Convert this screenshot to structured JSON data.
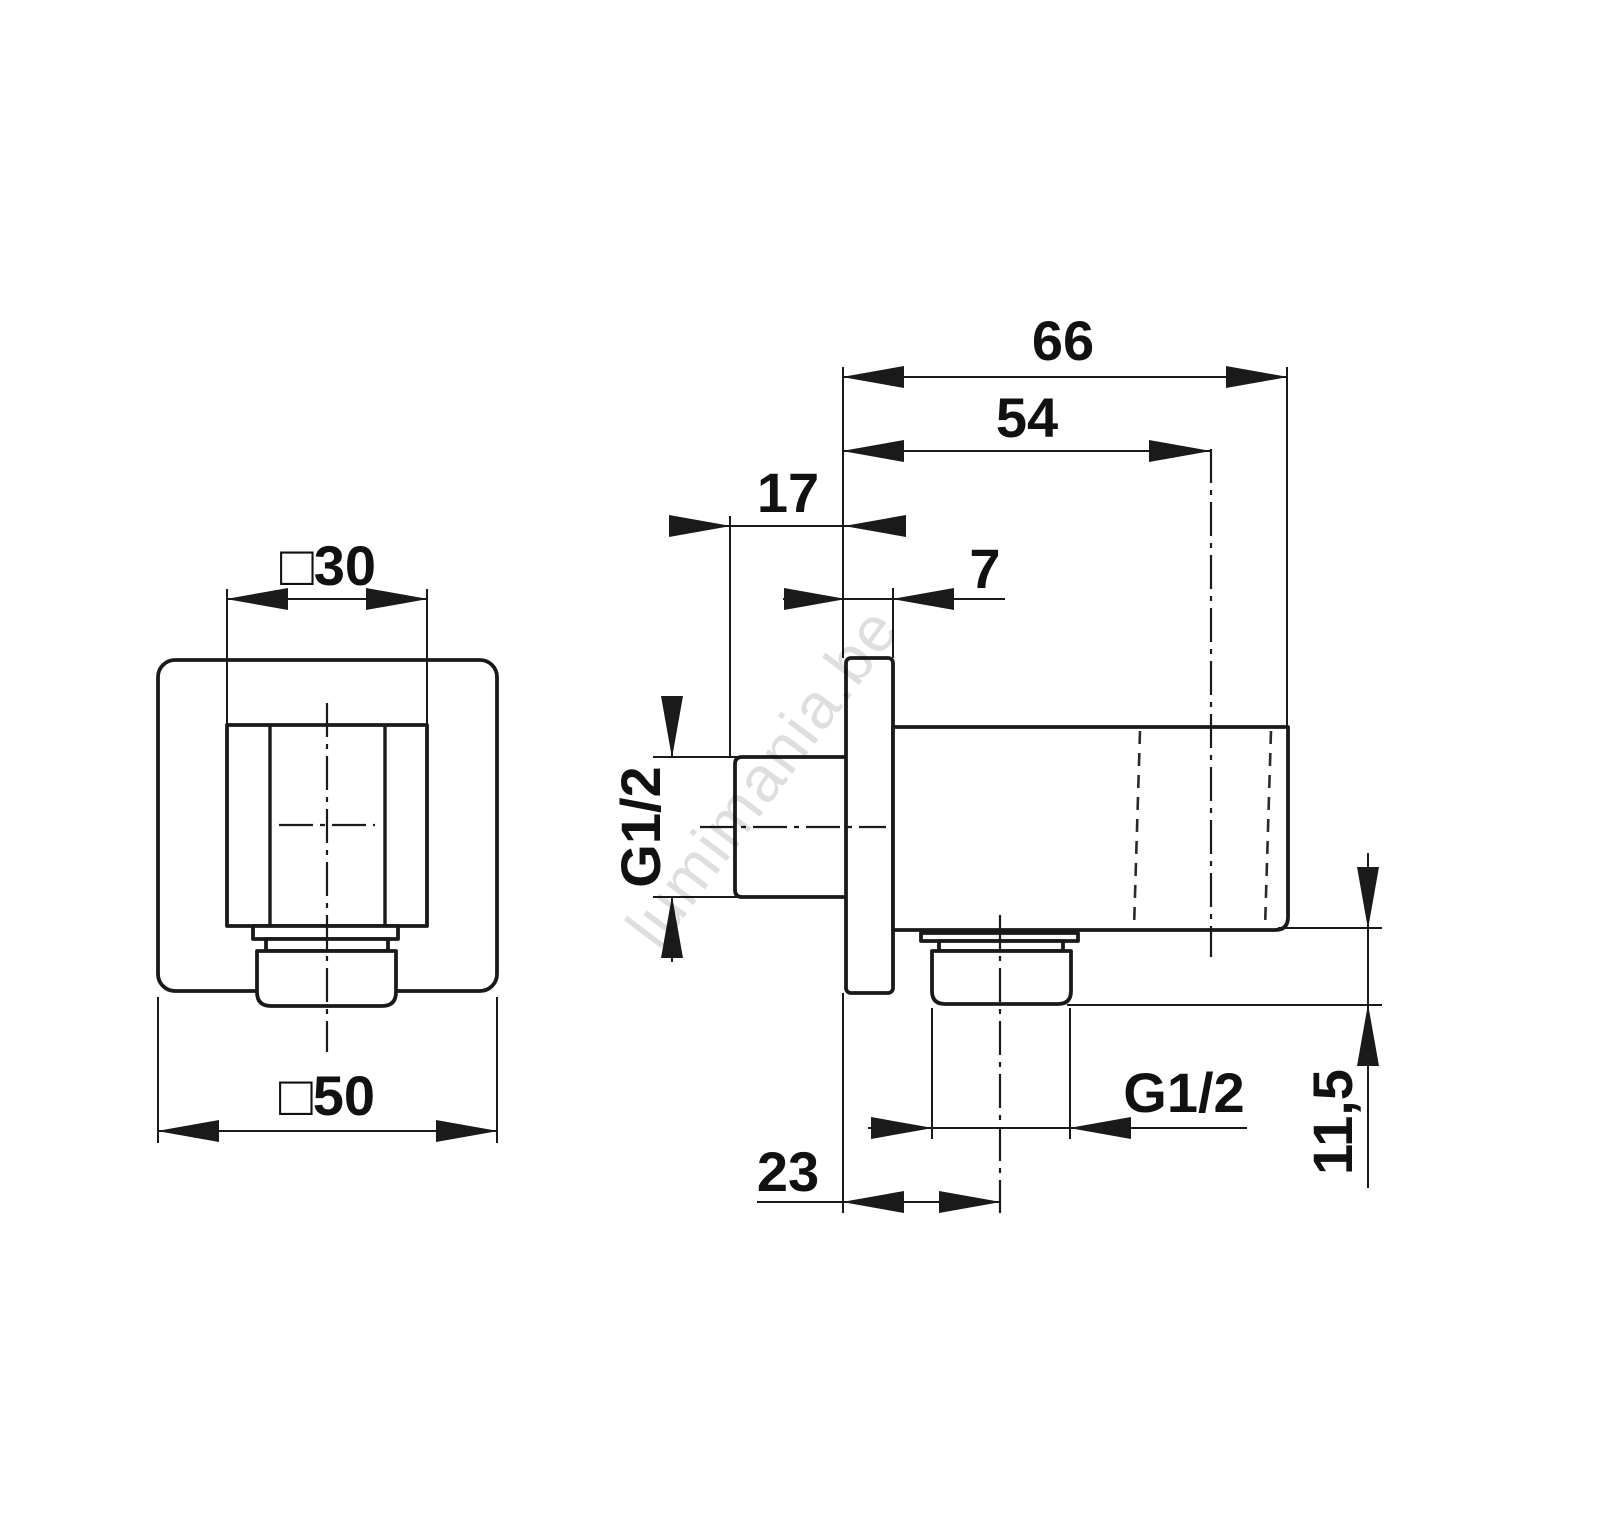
{
  "drawing": {
    "type": "technical-dimension-drawing",
    "subject": "square wall-outlet elbow, front view and side section view",
    "background_color": "#ffffff",
    "line_color": "#1a1a1a",
    "watermark": {
      "text": "lumimania.be",
      "color": "rgba(0,0,0,0.13)"
    },
    "labels": {
      "front_boss_width": "□30",
      "front_plate_width": "□50",
      "side_total_length": "66",
      "side_length_to_axis": "54",
      "side_nipple_length": "17",
      "side_plate_thickness": "7",
      "inlet_thread": "G1/2",
      "outlet_thread": "G1/2",
      "side_axis_offset": "23",
      "side_nut_height": "11,5"
    }
  }
}
